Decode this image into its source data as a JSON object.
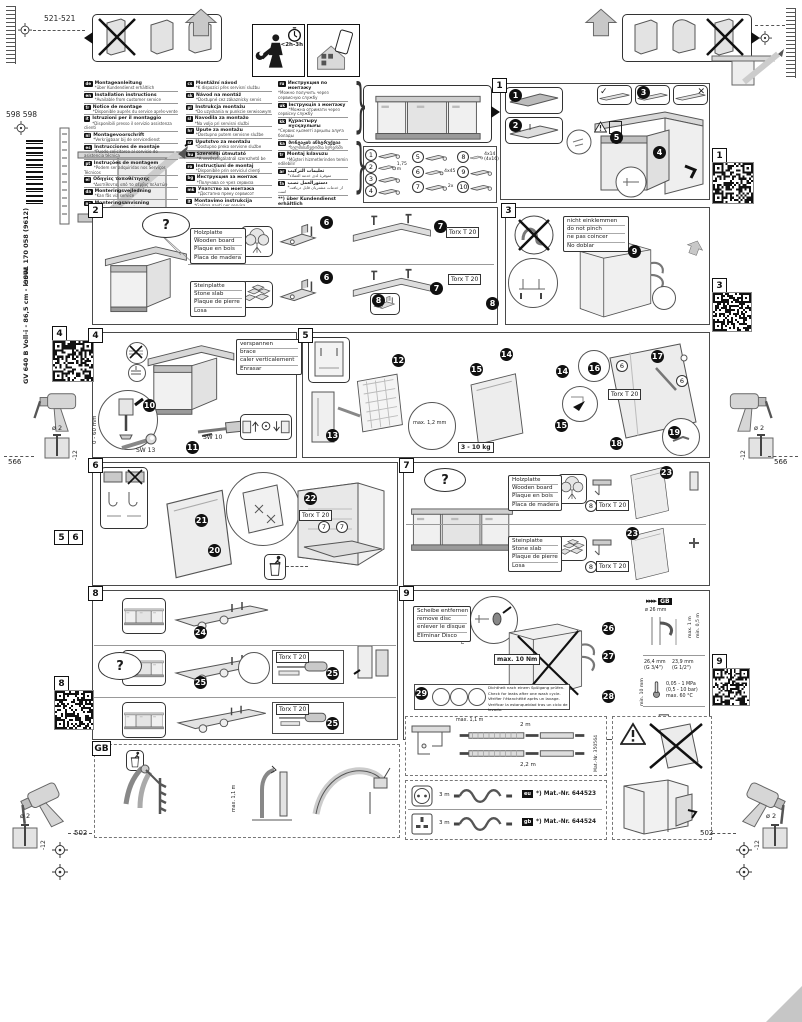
{
  "page": {
    "install_time": "<2h-3h",
    "spine": {
      "model": "GV 640 B Voll-i - 86,5 cm - k.SW",
      "number": "9001 170 058 (9612)"
    },
    "dims": {
      "top_left": "521-521",
      "left_upper": "598 598",
      "left_mid": "566",
      "right_mid": "566",
      "bottom_left": "502",
      "bottom_right": "502"
    },
    "drill": {
      "dia": "ø 2",
      "depth": "-12"
    }
  },
  "icons": {
    "check": "✓",
    "cross": "✕",
    "question": "?",
    "brace": "}",
    "arrows": "▸▸▸▸"
  },
  "shared": {
    "torx": "Torx T 20"
  },
  "materials": {
    "wood": [
      "Holzplatte",
      "Wooden board",
      "Plaque en bois",
      "Placa de madera"
    ],
    "stone": [
      "Steinplatte",
      "Stone slab",
      "Plaque de pierre",
      "Losa"
    ]
  },
  "languages": {
    "col1": [
      {
        "code": "de",
        "title": "Montageanleitung",
        "note": "*über Kundendienst erhältlich"
      },
      {
        "code": "en",
        "title": "Installation instructions",
        "note": "*Available from customer service"
      },
      {
        "code": "fr",
        "title": "Notice de montage",
        "note": "*Disponible auprès du service après-vente"
      },
      {
        "code": "it",
        "title": "Istruzioni per il montaggio",
        "note": "*Disponibili presso il servizio assistenza clienti"
      },
      {
        "code": "nl",
        "title": "Montagevoorschrift",
        "note": "*Verkrijgbaar bij de servicedienst"
      },
      {
        "code": "es",
        "title": "Instrucciones de montaje",
        "note": "*Puede solicitarse al servicio de asistencia técnica"
      },
      {
        "code": "pt",
        "title": "Instruções de montagem",
        "note": "*Podem ser adquiridas nos Serviços Técnicos"
      },
      {
        "code": "el",
        "title": "Οδηγίες τοποθέτησης",
        "note": "*Διατίθενται από το σέρβις πελατών"
      },
      {
        "code": "da",
        "title": "Monteringsvejledning",
        "note": "*Kan fås via service"
      },
      {
        "code": "no",
        "title": "Monteringsanvisning",
        "note": "*Fås hos kundeservice"
      },
      {
        "code": "sv",
        "title": "Monteringsanvisning",
        "note": "*Kan beställas via service"
      },
      {
        "code": "fi",
        "title": "Asennusohje",
        "note": "*Saatavana huoltopalvelusta"
      }
    ],
    "col2": [
      {
        "code": "cs",
        "title": "Montážní návod",
        "note": "*K dispozici přes servisní službu"
      },
      {
        "code": "sk",
        "title": "Návod na montáž",
        "note": "*Dostupné cez zákaznícky servis"
      },
      {
        "code": "pl",
        "title": "Instrukcja montażu",
        "note": "*Do uzyskania w punkcie serwisowym"
      },
      {
        "code": "sl",
        "title": "Navodila za montažo",
        "note": "*Na voljo pri servisni službi"
      },
      {
        "code": "hr",
        "title": "Upute za montažu",
        "note": "*Dostupno putem servisne službe"
      },
      {
        "code": "sr",
        "title": "Uputstvo za montažu",
        "note": "*Dostupno preko servisne službe"
      },
      {
        "code": "hu",
        "title": "Szerelési útmutató",
        "note": "*A vevőszolgálatnál szerezhető be"
      },
      {
        "code": "ro",
        "title": "Instrucţiuni de montaj",
        "note": "*Disponibile prin serviciul clienţi"
      },
      {
        "code": "bg",
        "title": "Инструкция за монтаж",
        "note": "*Получава се чрез сервиза"
      },
      {
        "code": "mk",
        "title": "Упатство за монтажа",
        "note": "*Достапно преку сервисот"
      },
      {
        "code": "lt",
        "title": "Montavimo instrukcija",
        "note": "*Galima gauti per servisą"
      },
      {
        "code": "lv",
        "title": "Montāžas instrukcija",
        "note": "*Pieejama klientu servisā"
      }
    ],
    "col3": [
      {
        "code": "ru",
        "title": "Инструкция по монтажу",
        "note": "*Можно получить через сервисную службу"
      },
      {
        "code": "uk",
        "title": "Інструкція з монтажу",
        "note": "*Можна отримати через сервісну службу"
      },
      {
        "code": "kk",
        "title": "Құрастыру нұсқаулығы",
        "note": "*Сервис қызметі арқылы алуға болады"
      },
      {
        "code": "ka",
        "title": "მონტაჟის ინსტრუქცია",
        "note": "*ხელმისაწვდომია სერვისში"
      },
      {
        "code": "tr",
        "title": "Montaj kılavuzu",
        "note": "*Müşteri hizmetlerinden temin edilebilir"
      },
      {
        "code": "ar",
        "title": "تعليمات التركيب",
        "note": "*متوفرة لدى خدمة العملاء"
      },
      {
        "code": "fa",
        "title": "دستورالعمل نصب",
        "note": "*از خدمات مشتریان قابل دریافت است"
      },
      {
        "code": "",
        "title": "**) über Kundendienst erhältlich",
        "note": "**) Available from Customer Service"
      },
      {
        "code": "ko",
        "title": "설치 설명서",
        "note": "*고객 서비스를 통해 구입 가능"
      },
      {
        "code": "zh",
        "title": "安装说明",
        "note": "*可通过客户服务获取"
      },
      {
        "code": "zh",
        "title": "安裝說明",
        "note": "*可透過客戶服務取得"
      }
    ]
  },
  "parts": {
    "col1": [
      {
        "num": "1",
        "note": ""
      },
      {
        "num": "2",
        "note": "1,75 m"
      },
      {
        "num": "3",
        "note": ""
      },
      {
        "num": "4",
        "note": ""
      }
    ],
    "col2": [
      {
        "num": "5",
        "note": ""
      },
      {
        "num": "6",
        "note": "4x45"
      },
      {
        "num": "7",
        "note": "2x"
      }
    ],
    "col3": [
      {
        "num": "8",
        "note": "4x14 (4x16)"
      },
      {
        "num": "9",
        "note": ""
      },
      {
        "num": "10",
        "note": ""
      }
    ]
  },
  "sections": {
    "s1": {
      "no": "1",
      "steps": [
        "1",
        "2",
        "3",
        "4",
        "5"
      ]
    },
    "s2": {
      "no": "2",
      "steps": [
        "6",
        "7",
        "8"
      ]
    },
    "s3": {
      "no": "3",
      "step": "9",
      "no_pinch": [
        "nicht einklemmen",
        "do not pinch",
        "ne pas coincer",
        "No doblar"
      ]
    },
    "s4": {
      "no": "4",
      "steps": [
        "10",
        "11"
      ],
      "brace": [
        "verspannen",
        "brace",
        "caler verticalement",
        "Enrasar"
      ],
      "range": "0 - 60 mm",
      "sw13": "SW 13",
      "sw10": "SW 10"
    },
    "s5": {
      "no": "5",
      "steps": [
        "12",
        "13",
        "14",
        "15",
        "16",
        "17",
        "18",
        "19"
      ],
      "gap": "max. 1,2 mm",
      "weight": "3 - 10 kg",
      "ref": "6"
    },
    "s6": {
      "no": "6",
      "steps": [
        "20",
        "21",
        "22"
      ],
      "ref": "7"
    },
    "s7": {
      "no": "7",
      "step": "23",
      "ref": "8"
    },
    "s8": {
      "no": "8",
      "steps": [
        "24",
        "25"
      ]
    },
    "s9": {
      "no": "9",
      "steps": [
        "26",
        "27",
        "28",
        "29"
      ],
      "remove_disc": [
        "Scheibe entfernen",
        "remove disc",
        "enlever le disque",
        "Eliminar Disco"
      ],
      "min_dia": "min. ø 18 mm",
      "torque": "max. 10 Nm",
      "leak_check": [
        "Dichtheit nach einem Spülgang prüfen.",
        "Check for leaks after one wash cycle.",
        "Vérifier l'étanchéité après un lavage.",
        "Verificar la estanqueidad tras un ciclo de lavado."
      ],
      "specs": {
        "gb": "GB",
        "drain_dia": "ø 26 mm",
        "drain_max": "max. 1 m",
        "drain_min": "min. 0,5 m",
        "g34a": "26,4 mm",
        "g34b": "(G 3/4\")",
        "g12a": "23,9 mm",
        "g12b": "(G 1/2\")",
        "clearance": "min. 10 mm",
        "p1": "0,05 - 1 MPa",
        "p2": "(0,5 - 10 bar)",
        "temp": "max. 60 °C"
      }
    }
  },
  "footer": {
    "gb_label": "GB",
    "gb_hose": "max. 1,1 m",
    "hoses": {
      "riser": "max. 1,1 m",
      "top": "2 m",
      "bottom": "2,2 m",
      "mat": "Mat.-Nr. 350564"
    },
    "power": {
      "rows": [
        {
          "plug": "eu",
          "len": "3 m",
          "mat": "*) Mat.-Nr. 644523"
        },
        {
          "plug": "gb",
          "len": "3 m",
          "mat": "*) Mat.-Nr. 644524"
        }
      ]
    }
  },
  "markers": {
    "q1": "1",
    "q3": "3",
    "q4": "4",
    "q8": "8",
    "q9": "9",
    "m5": "5",
    "m6": "6"
  }
}
